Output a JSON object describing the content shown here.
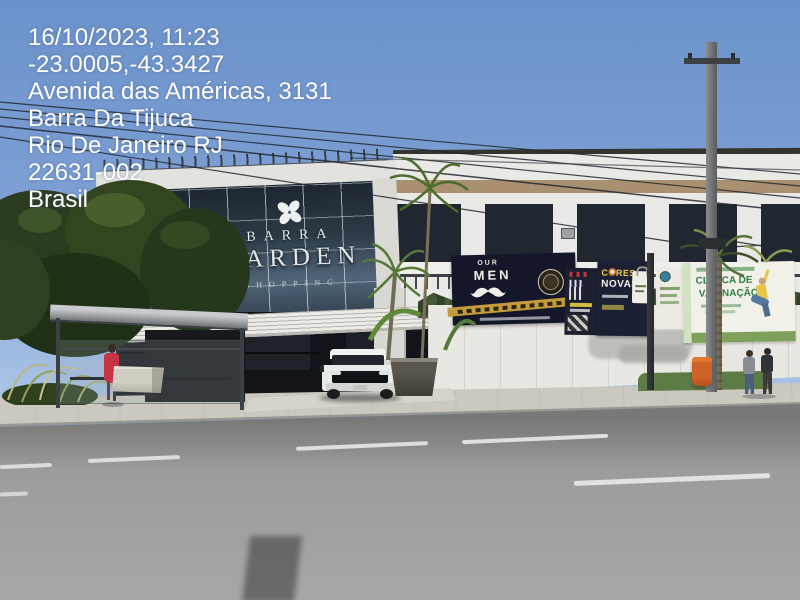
{
  "overlay": {
    "lines": [
      "16/10/2023, 11:23",
      "-23.0005,-43.3427",
      "Avenida das Américas, 3131",
      "Barra Da Tijuca",
      "Rio De Janeiro RJ",
      "22631-002",
      "Brasil"
    ]
  },
  "scene": {
    "building_sign": {
      "line1": "BARRA",
      "line2": "GARDEN",
      "line3": "SHOPPING"
    },
    "banners": {
      "barber": {
        "top": "OUR",
        "main": "MEN"
      },
      "paint": {
        "line1": "CORES",
        "line2": "NOVAS"
      },
      "clinic": {
        "line1": "CLÍNICA DE",
        "line2": "VACINAÇÃO"
      }
    },
    "colors": {
      "sky_top": "#6b92cb",
      "sky_bottom": "#b6cbe8",
      "glass_facade": "#26303c",
      "road": "#9c9c9a",
      "sidewalk": "#cbc8bf",
      "hedge_green": "#3a4c2d",
      "banner_navy": "#161a26",
      "accent_gold": "#c49b3c",
      "clinic_green": "#2f7d3f",
      "dress_red": "#c53544",
      "bin_orange": "#d2622a"
    }
  }
}
